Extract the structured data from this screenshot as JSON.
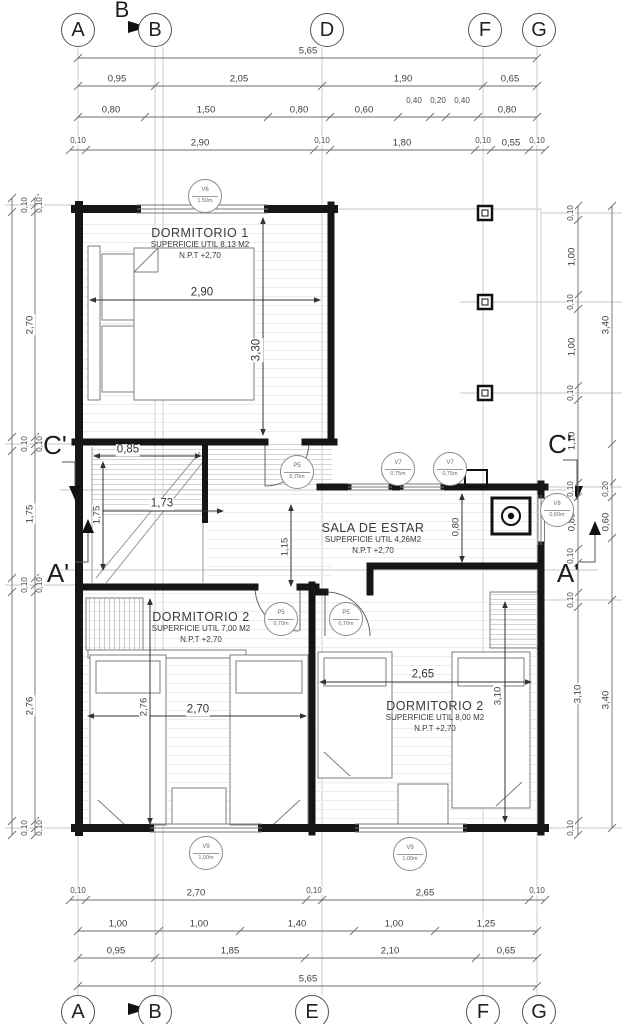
{
  "drawing": {
    "type_label": "floor-plan"
  },
  "section_b": {
    "label": "B"
  },
  "grid": {
    "top": [
      {
        "l": "A",
        "x": 78
      },
      {
        "l": "B",
        "x": 155
      },
      {
        "l": "D",
        "x": 327
      },
      {
        "l": "F",
        "x": 485
      },
      {
        "l": "G",
        "x": 539
      }
    ],
    "top_y": 30,
    "bottom": [
      {
        "l": "A",
        "x": 78
      },
      {
        "l": "B",
        "x": 155
      },
      {
        "l": "E",
        "x": 312
      },
      {
        "l": "F",
        "x": 483
      },
      {
        "l": "G",
        "x": 539
      }
    ],
    "bottom_y": 1012
  },
  "section_markers": [
    {
      "t": "C'",
      "x": 55,
      "y": 445
    },
    {
      "t": "C'",
      "x": 560,
      "y": 444
    },
    {
      "t": "A'",
      "x": 58,
      "y": 573
    },
    {
      "t": "A'",
      "x": 568,
      "y": 573
    }
  ],
  "rooms": [
    {
      "r1": "DORMITORIO 1",
      "r2": "SUPERFICIE UTIL 8,13 M2",
      "r3": "N.P.T +2,70",
      "x": 200,
      "y": 226
    },
    {
      "r1": "SALA DE ESTAR",
      "r2": "SUPERFICIE UTIL 4,26M2",
      "r3": "N.P.T +2,70",
      "x": 373,
      "y": 521
    },
    {
      "r1": "DORMITORIO 2",
      "r2": "SUPERFICIE UTIL 7,00 M2",
      "r3": "N.P.T +2,70",
      "x": 201,
      "y": 610
    },
    {
      "r1": "DORMITORIO 2",
      "r2": "SUPERFICIE UTIL 8,00 M2",
      "r3": "N.P.T +2,70",
      "x": 435,
      "y": 699
    }
  ],
  "tags": [
    {
      "top": "V6",
      "bot": "1.50m",
      "x": 205,
      "y": 196
    },
    {
      "top": "V7",
      "bot": "0,75m",
      "x": 398,
      "y": 469
    },
    {
      "top": "V7",
      "bot": "0,75m",
      "x": 450,
      "y": 469
    },
    {
      "top": "V8",
      "bot": "0,60m",
      "x": 557,
      "y": 510
    },
    {
      "top": "P5",
      "bot": "0,70m",
      "x": 297,
      "y": 472
    },
    {
      "top": "P5",
      "bot": "0,70m",
      "x": 281,
      "y": 619
    },
    {
      "top": "P5",
      "bot": "0,70m",
      "x": 346,
      "y": 619
    },
    {
      "top": "V9",
      "bot": "1,00m",
      "x": 206,
      "y": 853
    },
    {
      "top": "V9",
      "bot": "1,00m",
      "x": 410,
      "y": 854
    }
  ],
  "dim_labels": [
    {
      "t": "5,65",
      "x": 308,
      "y": 51
    },
    {
      "t": "0,95",
      "x": 117,
      "y": 79
    },
    {
      "t": "2,05",
      "x": 239,
      "y": 79
    },
    {
      "t": "1,90",
      "x": 403,
      "y": 79
    },
    {
      "t": "0,65",
      "x": 510,
      "y": 79
    },
    {
      "t": "0,80",
      "x": 111,
      "y": 110
    },
    {
      "t": "1,50",
      "x": 206,
      "y": 110
    },
    {
      "t": "0,80",
      "x": 299,
      "y": 110
    },
    {
      "t": "0,60",
      "x": 364,
      "y": 110
    },
    {
      "t": "0,40",
      "x": 414,
      "y": 101,
      "sm": 1
    },
    {
      "t": "0,20",
      "x": 438,
      "y": 101,
      "sm": 1
    },
    {
      "t": "0,40",
      "x": 462,
      "y": 101,
      "sm": 1
    },
    {
      "t": "0,80",
      "x": 507,
      "y": 110
    },
    {
      "t": "0,10",
      "x": 78,
      "y": 141,
      "sm": 1
    },
    {
      "t": "2,90",
      "x": 200,
      "y": 143
    },
    {
      "t": "0,10",
      "x": 322,
      "y": 141,
      "sm": 1
    },
    {
      "t": "1,80",
      "x": 402,
      "y": 143
    },
    {
      "t": "0,10",
      "x": 483,
      "y": 141,
      "sm": 1
    },
    {
      "t": "0,55",
      "x": 511,
      "y": 143
    },
    {
      "t": "0,10",
      "x": 537,
      "y": 141,
      "sm": 1
    },
    {
      "t": "0,10",
      "x": 78,
      "y": 891,
      "sm": 1
    },
    {
      "t": "2,70",
      "x": 196,
      "y": 893
    },
    {
      "t": "0,10",
      "x": 314,
      "y": 891,
      "sm": 1
    },
    {
      "t": "2,65",
      "x": 425,
      "y": 893
    },
    {
      "t": "0,10",
      "x": 537,
      "y": 891,
      "sm": 1
    },
    {
      "t": "1,00",
      "x": 118,
      "y": 924
    },
    {
      "t": "1,00",
      "x": 199,
      "y": 924
    },
    {
      "t": "1,40",
      "x": 297,
      "y": 924
    },
    {
      "t": "1,00",
      "x": 394,
      "y": 924
    },
    {
      "t": "1,25",
      "x": 486,
      "y": 924
    },
    {
      "t": "0,95",
      "x": 116,
      "y": 951
    },
    {
      "t": "1,85",
      "x": 230,
      "y": 951
    },
    {
      "t": "2,10",
      "x": 390,
      "y": 951
    },
    {
      "t": "0,65",
      "x": 506,
      "y": 951
    },
    {
      "t": "5,65",
      "x": 308,
      "y": 979
    },
    {
      "t": "0,10",
      "x": 25,
      "y": 205,
      "r": 1,
      "sm": 1
    },
    {
      "t": "0,10",
      "x": 40,
      "y": 205,
      "r": 1,
      "sm": 1
    },
    {
      "t": "2,70",
      "x": 30,
      "y": 325,
      "r": 1
    },
    {
      "t": "0,10",
      "x": 25,
      "y": 444,
      "r": 1,
      "sm": 1
    },
    {
      "t": "0,10",
      "x": 40,
      "y": 444,
      "r": 1,
      "sm": 1
    },
    {
      "t": "1,75",
      "x": 30,
      "y": 514,
      "r": 1
    },
    {
      "t": "0,10",
      "x": 25,
      "y": 585,
      "r": 1,
      "sm": 1
    },
    {
      "t": "0,10",
      "x": 40,
      "y": 585,
      "r": 1,
      "sm": 1
    },
    {
      "t": "2,76",
      "x": 30,
      "y": 706,
      "r": 1
    },
    {
      "t": "0,10",
      "x": 25,
      "y": 828,
      "r": 1,
      "sm": 1
    },
    {
      "t": "0,10",
      "x": 40,
      "y": 828,
      "r": 1,
      "sm": 1
    },
    {
      "t": "0,10",
      "x": 571,
      "y": 213,
      "r": 1,
      "sm": 1
    },
    {
      "t": "1,00",
      "x": 572,
      "y": 257,
      "r": 1
    },
    {
      "t": "0,10",
      "x": 571,
      "y": 302,
      "r": 1,
      "sm": 1
    },
    {
      "t": "1,00",
      "x": 572,
      "y": 347,
      "r": 1
    },
    {
      "t": "0,10",
      "x": 571,
      "y": 393,
      "r": 1,
      "sm": 1
    },
    {
      "t": "1,10",
      "x": 572,
      "y": 441,
      "r": 1
    },
    {
      "t": "0,10",
      "x": 571,
      "y": 489,
      "r": 1,
      "sm": 1
    },
    {
      "t": "0,80",
      "x": 572,
      "y": 522,
      "r": 1
    },
    {
      "t": "0,10",
      "x": 571,
      "y": 556,
      "r": 1,
      "sm": 1
    },
    {
      "t": "0,10",
      "x": 571,
      "y": 600,
      "r": 1,
      "sm": 1
    },
    {
      "t": "3,10",
      "x": 578,
      "y": 694,
      "r": 1
    },
    {
      "t": "0,10",
      "x": 571,
      "y": 828,
      "r": 1,
      "sm": 1
    },
    {
      "t": "3,40",
      "x": 606,
      "y": 325,
      "r": 1
    },
    {
      "t": "0,20",
      "x": 606,
      "y": 489,
      "r": 1,
      "sm": 1
    },
    {
      "t": "0,60",
      "x": 606,
      "y": 522,
      "r": 1
    },
    {
      "t": "3,40",
      "x": 606,
      "y": 700,
      "r": 1
    },
    {
      "t": "2,90",
      "x": 202,
      "y": 293,
      "md": 1
    },
    {
      "t": "3,30",
      "x": 257,
      "y": 350,
      "r": 1,
      "md": 1
    },
    {
      "t": "0,85",
      "x": 128,
      "y": 450,
      "md": 1
    },
    {
      "t": "1,73",
      "x": 162,
      "y": 504,
      "md": 1
    },
    {
      "t": "1,75",
      "x": 97,
      "y": 515,
      "r": 1
    },
    {
      "t": "1,15",
      "x": 285,
      "y": 547,
      "r": 1
    },
    {
      "t": "0,80",
      "x": 456,
      "y": 527,
      "r": 1
    },
    {
      "t": "2,76",
      "x": 144,
      "y": 707,
      "r": 1
    },
    {
      "t": "2,70",
      "x": 198,
      "y": 710,
      "md": 1
    },
    {
      "t": "2,65",
      "x": 423,
      "y": 675,
      "md": 1
    },
    {
      "t": "3,10",
      "x": 498,
      "y": 696,
      "r": 1
    }
  ],
  "chains": [
    {
      "o": "h",
      "p": 58,
      "ticks": [
        78,
        537
      ]
    },
    {
      "o": "h",
      "p": 86,
      "ticks": [
        78,
        155,
        322,
        483,
        537
      ]
    },
    {
      "o": "h",
      "p": 117,
      "ticks": [
        78,
        145,
        268,
        330,
        398,
        430,
        446,
        478,
        537
      ]
    },
    {
      "o": "h",
      "p": 150,
      "ticks": [
        70,
        86,
        314,
        330,
        475,
        491,
        529,
        545
      ]
    },
    {
      "o": "h",
      "p": 900,
      "ticks": [
        70,
        86,
        306,
        322,
        529,
        545
      ]
    },
    {
      "o": "h",
      "p": 931,
      "ticks": [
        78,
        159,
        240,
        354,
        435,
        537
      ]
    },
    {
      "o": "h",
      "p": 958,
      "ticks": [
        78,
        155,
        305,
        476,
        537
      ]
    },
    {
      "o": "h",
      "p": 986,
      "ticks": [
        78,
        537
      ]
    },
    {
      "o": "v",
      "p": 35,
      "ticks": [
        198,
        205,
        212,
        437,
        444,
        451,
        578,
        585,
        592,
        821,
        828,
        835
      ]
    },
    {
      "o": "v",
      "p": 12,
      "ticks": [
        198,
        212,
        437,
        451,
        578,
        592,
        821,
        835
      ]
    },
    {
      "o": "v",
      "p": 578,
      "ticks": [
        206,
        220,
        295,
        309,
        386,
        400,
        483,
        497,
        549,
        563,
        593,
        607,
        821,
        835
      ]
    },
    {
      "o": "v",
      "p": 612,
      "ticks": [
        206,
        444,
        483,
        497,
        538,
        600,
        828
      ]
    }
  ]
}
